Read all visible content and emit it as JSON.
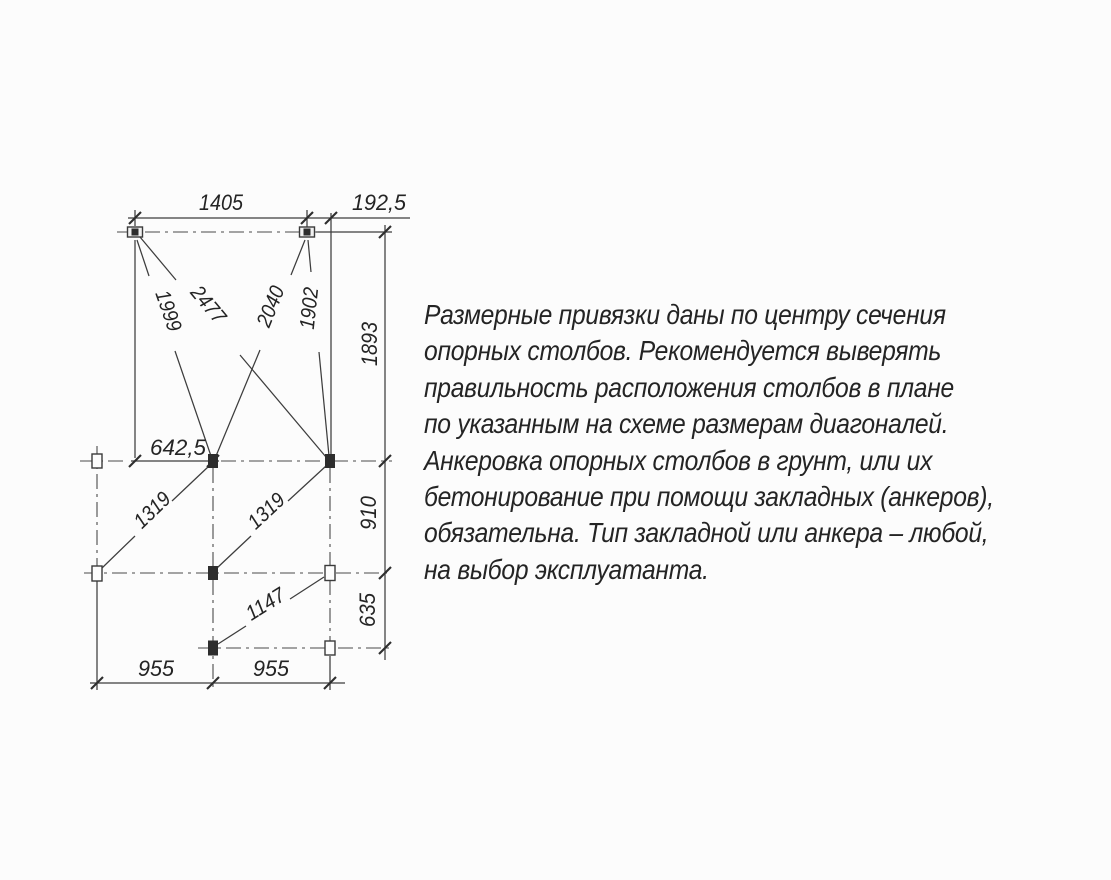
{
  "drawing": {
    "dimensions": {
      "top_span": "1405",
      "top_right_offset": "192,5",
      "right_upper": "1893",
      "right_middle": "910",
      "right_lower": "635",
      "diag_tl_mc": "1999",
      "diag_tl_mr": "2477",
      "diag_tr_mc": "2040",
      "diag_tr_mr": "1902",
      "mid_left_offset": "642,5",
      "diag_ll_mc": "1319",
      "diag_lc_mr": "1319",
      "diag_bc_lr": "1147",
      "bottom_left_span": "955",
      "bottom_right_span": "955"
    }
  },
  "note": {
    "lines": [
      "Размерные привязки даны по центру сечения",
      "опорных столбов. Рекомендуется выверять",
      "правильность расположения столбов в плане",
      "по указанным на схеме размерам диагоналей.",
      "Анкеровка опорных столбов в грунт, или их",
      "бетонирование при помощи закладных (анкеров),",
      "обязательна. Тип закладной или анкера – любой,",
      "на выбор эксплуатанта."
    ]
  },
  "colors": {
    "background": "#fcfcfc",
    "line": "#3d3d3d",
    "text": "#242424"
  }
}
